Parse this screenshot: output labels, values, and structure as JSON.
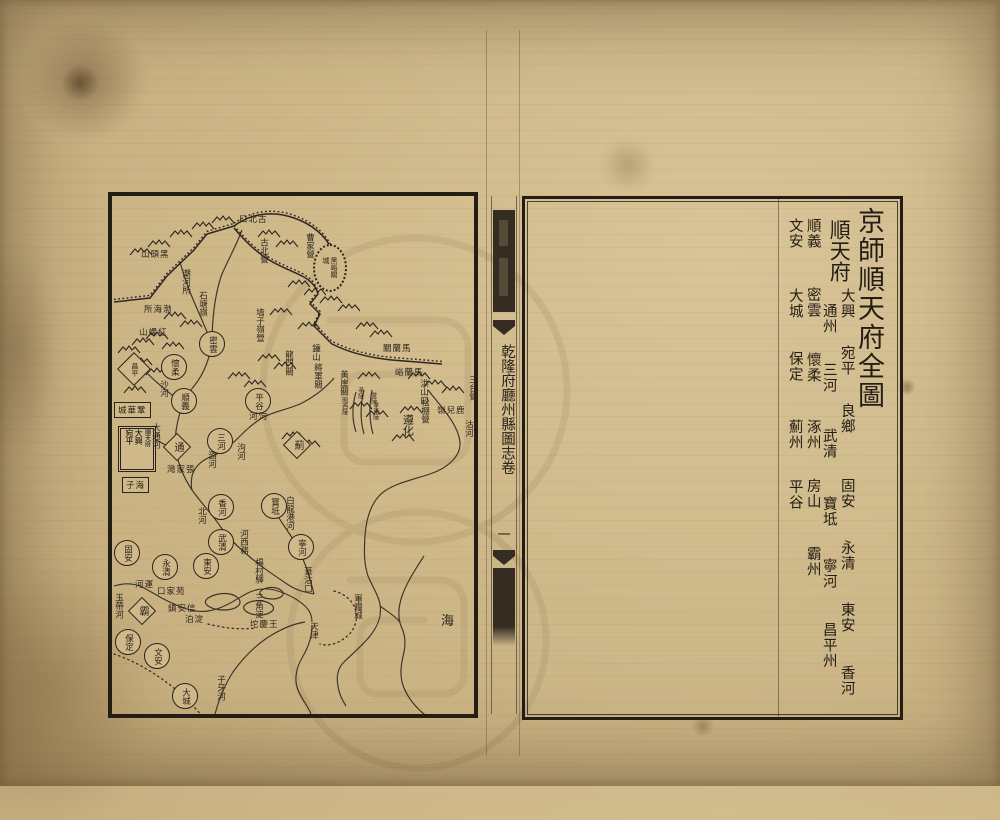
{
  "colors": {
    "paper": "#cfb98a",
    "ink": "#2b241a",
    "bar": "#352c22"
  },
  "fold": {
    "title": "乾隆府廳州縣圖志卷",
    "volume": "一"
  },
  "right_page": {
    "map_title": "京師順天府全圖",
    "prefecture_header": "順天府",
    "counties_inner_right": [
      "大興",
      "宛平",
      "良鄉",
      "固安",
      "永清",
      "東安",
      "香河"
    ],
    "counties_inner_left": [
      "通州",
      "三河",
      "武清",
      "寶坻",
      "寧河",
      "昌平州"
    ],
    "counties_col3": [
      "順義",
      "密雲",
      "懷柔",
      "涿州",
      "房山",
      "霸州"
    ],
    "counties_col4": [
      "文安",
      "大城",
      "保定",
      "薊州",
      "平谷"
    ]
  },
  "map": {
    "capital_box": {
      "prefecture": "順天府",
      "counties": [
        "大興",
        "宛平"
      ]
    },
    "sea_label": "海",
    "circles": [
      {
        "n": "密雲",
        "x": 99,
        "y": 147
      },
      {
        "n": "懷柔",
        "x": 61,
        "y": 170
      },
      {
        "n": "順義",
        "x": 71,
        "y": 204
      },
      {
        "n": "三河",
        "x": 107,
        "y": 244
      },
      {
        "n": "平谷",
        "x": 145,
        "y": 204
      },
      {
        "n": "香河",
        "x": 108,
        "y": 310
      },
      {
        "n": "寶坻",
        "x": 161,
        "y": 309
      },
      {
        "n": "寧河",
        "x": 188,
        "y": 350
      },
      {
        "n": "武清",
        "x": 108,
        "y": 345
      },
      {
        "n": "東安",
        "x": 93,
        "y": 369
      },
      {
        "n": "永清",
        "x": 52,
        "y": 370
      },
      {
        "n": "固安",
        "x": 14,
        "y": 356
      },
      {
        "n": "保定",
        "x": 15,
        "y": 445
      },
      {
        "n": "文安",
        "x": 44,
        "y": 459
      },
      {
        "n": "大城",
        "x": 72,
        "y": 499
      }
    ],
    "diamonds": [
      {
        "n": "昌平",
        "x": 21,
        "y": 172,
        "s": 22,
        "fs": 7
      },
      {
        "n": "通",
        "x": 64,
        "y": 250,
        "s": 18,
        "fs": 10
      },
      {
        "n": "薊",
        "x": 184,
        "y": 248,
        "s": 18,
        "fs": 10
      },
      {
        "n": "霸",
        "x": 29,
        "y": 414,
        "s": 18,
        "fs": 10
      }
    ],
    "oval": {
      "n": "黑峪關城",
      "x": 216,
      "y": 70
    },
    "boxes": [
      {
        "n": "鞏華城",
        "x": 2,
        "y": 206
      },
      {
        "n": "海子",
        "x": 10,
        "y": 281
      }
    ],
    "vlabels": [
      {
        "n": "潮河所",
        "x": 68,
        "y": 73
      },
      {
        "n": "石塘嶺",
        "x": 85,
        "y": 95
      },
      {
        "n": "古北營",
        "x": 146,
        "y": 42
      },
      {
        "n": "曹家營",
        "x": 192,
        "y": 37
      },
      {
        "n": "墙子嶺營",
        "x": 142,
        "y": 112
      },
      {
        "n": "鍾山",
        "x": 198,
        "y": 148
      },
      {
        "n": "龍門關",
        "x": 171,
        "y": 154
      },
      {
        "n": "將軍關",
        "x": 200,
        "y": 167
      },
      {
        "n": "黃崖關",
        "x": 226,
        "y": 174
      },
      {
        "n": "孝陵",
        "x": 244,
        "y": 191,
        "fs": 6
      },
      {
        "n": "景陵",
        "x": 257,
        "y": 196,
        "fs": 6
      },
      {
        "n": "昭西陵",
        "x": 228,
        "y": 201,
        "fs": 6
      },
      {
        "n": "孝東陵",
        "x": 259,
        "y": 206,
        "fs": 6
      },
      {
        "n": "松棚營",
        "x": 307,
        "y": 202
      },
      {
        "n": "遵化",
        "x": 289,
        "y": 218,
        "fs": 11
      },
      {
        "n": "三台營",
        "x": 355,
        "y": 179
      },
      {
        "n": "洪山口",
        "x": 306,
        "y": 183
      },
      {
        "n": "沽河",
        "x": 351,
        "y": 224
      },
      {
        "n": "泃河",
        "x": 123,
        "y": 247
      },
      {
        "n": "沙河",
        "x": 46,
        "y": 184
      },
      {
        "n": "大通河",
        "x": 38,
        "y": 227
      },
      {
        "n": "潞河",
        "x": 94,
        "y": 255
      },
      {
        "n": "北河",
        "x": 84,
        "y": 311
      },
      {
        "n": "白龍港河",
        "x": 172,
        "y": 300
      },
      {
        "n": "河西務",
        "x": 126,
        "y": 333
      },
      {
        "n": "楊村驛",
        "x": 141,
        "y": 362
      },
      {
        "n": "玉帶河",
        "x": 1,
        "y": 397
      },
      {
        "n": "三角淀",
        "x": 141,
        "y": 397
      },
      {
        "n": "葦沽口",
        "x": 190,
        "y": 371
      },
      {
        "n": "天津",
        "x": 196,
        "y": 426
      },
      {
        "n": "軍糧城",
        "x": 240,
        "y": 398
      },
      {
        "n": "子牙河",
        "x": 103,
        "y": 479
      }
    ],
    "hlabels": [
      {
        "n": "古北口",
        "x": 127,
        "y": 17
      },
      {
        "n": "黑頭山",
        "x": 29,
        "y": 52
      },
      {
        "n": "渤海所",
        "x": 32,
        "y": 107
      },
      {
        "n": "紅螺山",
        "x": 27,
        "y": 130
      },
      {
        "n": "馬蘭關",
        "x": 271,
        "y": 146
      },
      {
        "n": "馬蘭峪",
        "x": 283,
        "y": 170
      },
      {
        "n": "鹿兒嶺",
        "x": 325,
        "y": 208
      },
      {
        "n": "泃河",
        "x": 137,
        "y": 214
      },
      {
        "n": "張家灣",
        "x": 55,
        "y": 267
      },
      {
        "n": "運河",
        "x": 23,
        "y": 382
      },
      {
        "n": "苑家口",
        "x": 45,
        "y": 389
      },
      {
        "n": "信安鎮",
        "x": 56,
        "y": 406
      },
      {
        "n": "淀泊",
        "x": 73,
        "y": 417
      },
      {
        "n": "王慶坨",
        "x": 138,
        "y": 422
      },
      {
        "n": "海",
        "x": 329,
        "y": 414,
        "fs": 13
      }
    ]
  }
}
